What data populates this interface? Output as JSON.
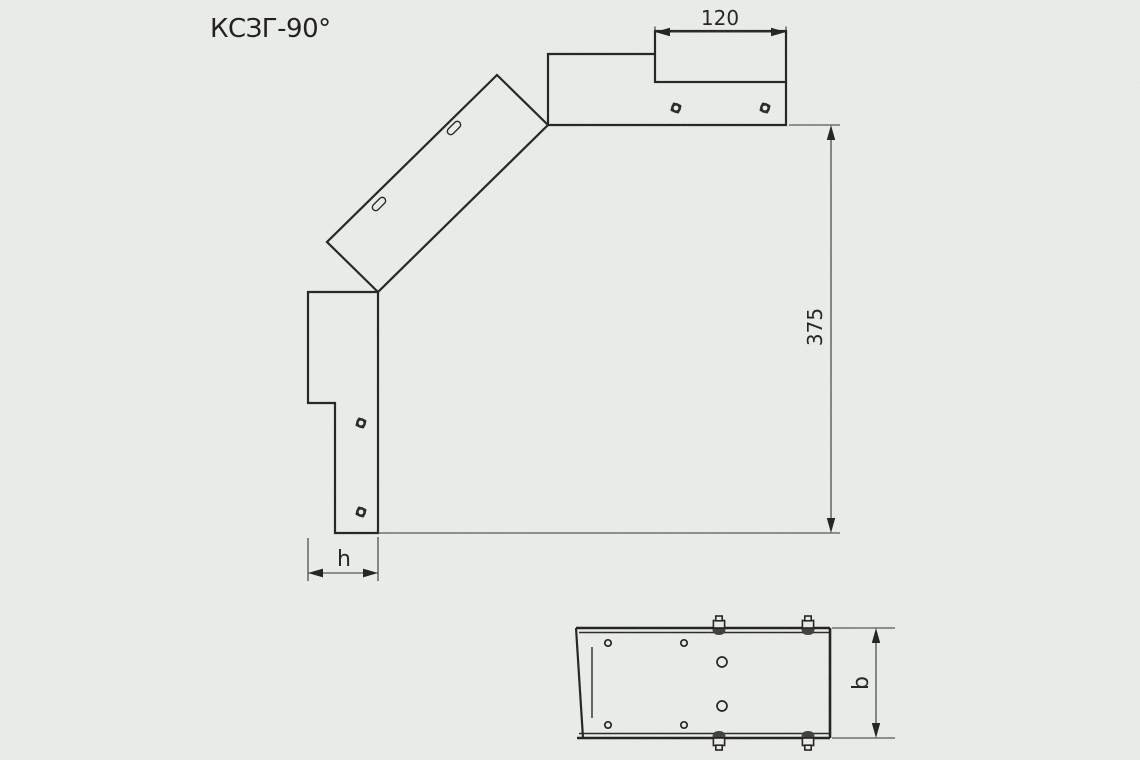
{
  "title": "КСЗГ-90°",
  "colors": {
    "background": "#edefec",
    "line": "#1c1c1c"
  },
  "main_view": {
    "description": "side view of 90-degree bend cover",
    "dimensions": {
      "connector_length": "120",
      "overall_height": "375",
      "side_height": "h"
    },
    "bolt_count": 4,
    "slot_count": 2
  },
  "bottom_view": {
    "description": "bottom view of connector end",
    "dimensions": {
      "tray_width": "b"
    },
    "bolt_count": 4,
    "small_hole_count": 4,
    "large_hole_count": 2
  }
}
